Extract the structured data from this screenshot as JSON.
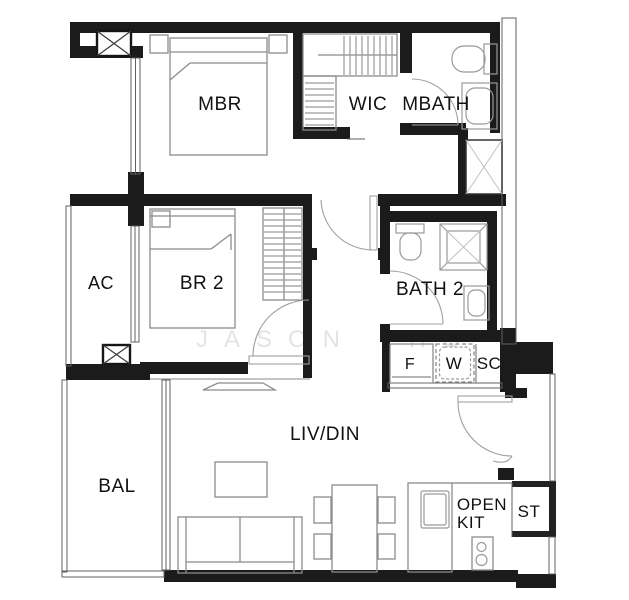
{
  "rooms": {
    "master_bedroom": "MBR",
    "walk_in_closet": "WIC",
    "master_bath": "MBATH",
    "ac_ledge": "AC",
    "bedroom2": "BR 2",
    "bath2": "BATH 2",
    "fridge": "F",
    "washer": "W",
    "service_cabinet": "SC",
    "balcony": "BAL",
    "living_dining": "LIV/DIN",
    "open_kitchen_line1": "OPEN",
    "open_kitchen_line2": "KIT",
    "store": "ST"
  },
  "watermark": "JASON HO",
  "colors": {
    "wall": "#1b1b1b",
    "wall_dark": "#222222",
    "furniture": "#8b8b8b",
    "fixture": "#9a9a9a",
    "thin": "#606060",
    "door": "#a0a0a0",
    "label": "#111111",
    "watermark": "#e4e4e4",
    "x_mark": "#c0c0c0",
    "background": "#ffffff"
  }
}
